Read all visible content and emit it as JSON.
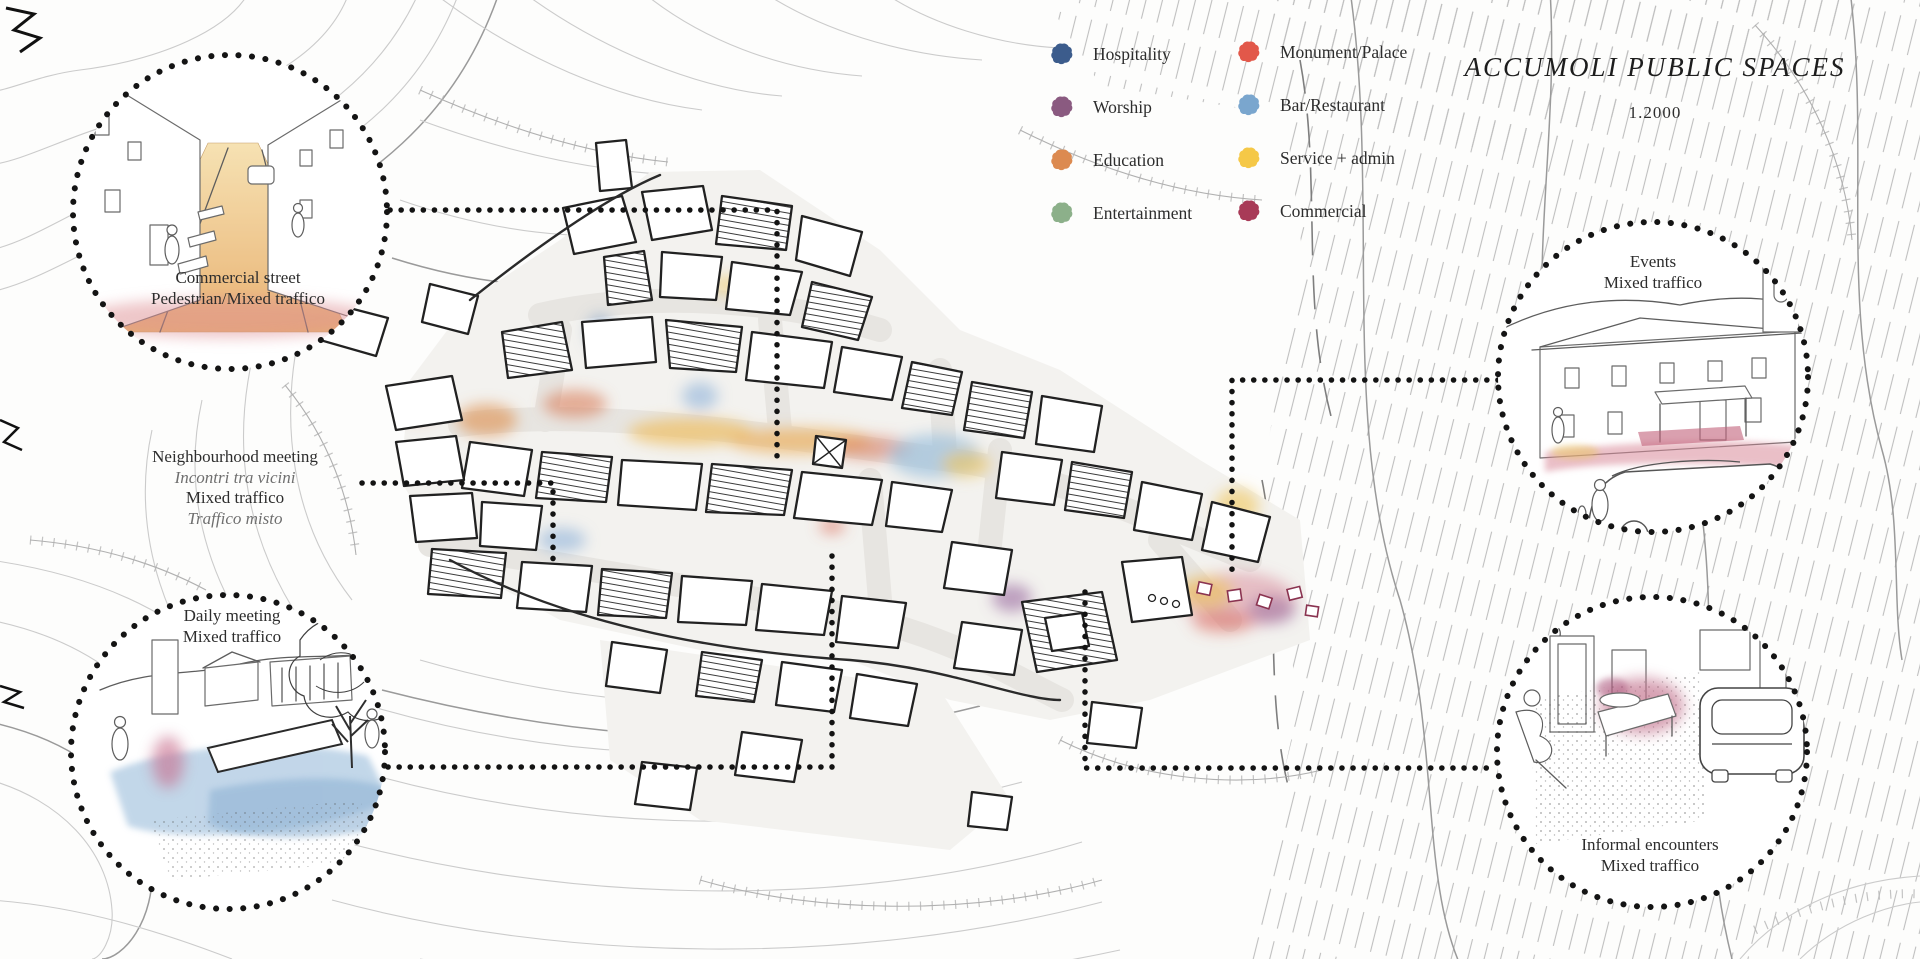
{
  "title": {
    "text": "ACCUMOLI PUBLIC SPACES",
    "scale": "1.2000"
  },
  "legend": {
    "columns": [
      {
        "items": [
          {
            "label": "Hospitality",
            "color": "#3c5c8c"
          },
          {
            "label": "Worship",
            "color": "#8a5a80"
          },
          {
            "label": "Education",
            "color": "#dc8a50"
          },
          {
            "label": "Entertainment",
            "color": "#8cb08a"
          }
        ]
      },
      {
        "items": [
          {
            "label": "Monument/Palace",
            "color": "#e2584a"
          },
          {
            "label": "Bar/Restaurant",
            "color": "#7aa6ce"
          },
          {
            "label": "Service + admin",
            "color": "#f5c847"
          },
          {
            "label": "Commercial",
            "color": "#a83a57"
          }
        ]
      }
    ]
  },
  "callouts": {
    "commercial_street": {
      "lines": [
        "Commercial street",
        "Pedestrian/Mixed traffico"
      ]
    },
    "neighbourhood_meeting": {
      "lines": [
        "Neighbourhood meeting",
        "Incontri tra vicini",
        "Mixed traffico",
        "Traffico misto"
      ]
    },
    "daily_meeting": {
      "lines": [
        "Daily meeting",
        "Mixed traffico"
      ]
    },
    "events": {
      "lines": [
        "Events",
        "Mixed traffico"
      ]
    },
    "informal_encounters": {
      "lines": [
        "Informal encounters",
        "Mixed traffico"
      ]
    }
  }
}
